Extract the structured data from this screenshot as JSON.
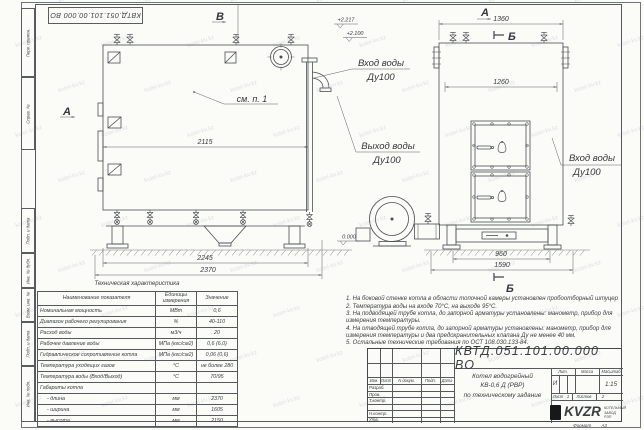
{
  "watermark": {
    "text": "kotel-kv.kz"
  },
  "frame": {
    "stamp_rotated": "КВТД.051.101.00.000 ВО",
    "side_top": [
      "Перв. примен.",
      "Справ. №"
    ],
    "side_bottom": [
      "Подп. и дата",
      "Инв. № дубл.",
      "Взам. инв. №",
      "Подп. и дата",
      "Инв. № подл."
    ]
  },
  "drawing": {
    "markers": {
      "view_a_side": "А",
      "view_b_top": "В",
      "view_a_front": "А",
      "section_b_top": "Б",
      "section_b_bottom": "Б"
    },
    "see_item": "см. п. 1",
    "labels": {
      "inlet_top_1": "Вход воды",
      "inlet_top_2": "Ду100",
      "outlet_1": "Выход воды",
      "outlet_2": "Ду100",
      "inlet_right_1": "Вход воды",
      "inlet_right_2": "Ду100"
    },
    "elevations": {
      "e1": "+2.217",
      "e2": "+2.100",
      "zero": "0.000"
    },
    "dims": {
      "side_top": "2115",
      "side_mid": "2245",
      "side_full": "2370",
      "front_top": "1360",
      "front_inner": "1260",
      "front_base": "960",
      "front_full": "1590"
    }
  },
  "tech_table": {
    "title": "Техническая характеристика",
    "headers": [
      "Наименование показателя",
      "Единицы измерения",
      "Значение"
    ],
    "rows": [
      [
        "Номинальная мощность",
        "МВт",
        "0,6"
      ],
      [
        "Диапазон рабочего регулирования",
        "%",
        "40-110"
      ],
      [
        "Расход воды",
        "м3/ч",
        "20"
      ],
      [
        "Рабочее давление воды",
        "МПа (кгс/см2)",
        "0,6 (6,0)"
      ],
      [
        "Гидравлическое сопротивление котла",
        "МПа (кгс/см2)",
        "0,06 (0,6)"
      ],
      [
        "Температура уходящих газов",
        "°С",
        "не более 280"
      ],
      [
        "Температура воды (Вход/Выход)",
        "°С",
        "70/95"
      ],
      [
        "Габариты котла",
        "",
        ""
      ],
      [
        "- длина",
        "мм",
        "2370"
      ],
      [
        "- ширина",
        "мм",
        "1605"
      ],
      [
        "- высота",
        "мм",
        "2150"
      ]
    ]
  },
  "notes": [
    "1. На боковой стенке котла в области топочной камеры установлен пробоотборный штуцер",
    "2. Температура воды на входе 70°С, на выходе 95°С.",
    "3. На подводящей трубе котла, до запорной арматуры установлены: манометр, прибор для измерения температуры.",
    "4. На отводящей трубе котла, до запорной арматуры установлены: манометр, прибор для измерения температуры и два предохранительных клапана Ду не менее 40 мм.",
    "5. Остальные технические требования по ОСТ 108.030.133-84."
  ],
  "title_block": {
    "designation": "КВТД.051.101.00.000  ВО",
    "columns": [
      "Изм.",
      "Лист",
      "N докум.",
      "Подп.",
      "Дата"
    ],
    "rows": [
      "Разраб.",
      "Пров.",
      "Т.контр.",
      "",
      "Н.контр.",
      "Утв."
    ],
    "product_line1": "Котел водогрейный",
    "product_line2": "КВ-0,6  Д  (РВР)",
    "product_line3": "по техническому задание",
    "lit_label": "Лит.",
    "mass_label": "Масса",
    "scale_label": "Масштаб",
    "lit_value": "И",
    "scale_value": "1:15",
    "sheet_label": "Лист",
    "sheet_value": "1",
    "sheets_label": "Листов",
    "sheets_value": "2",
    "logo_text": "KVZR",
    "logo_line1": "КОТЕЛЬНЫЙ",
    "logo_line2": "ЗАВОД РЭП",
    "format_label": "Формат",
    "format_value": "А3"
  }
}
